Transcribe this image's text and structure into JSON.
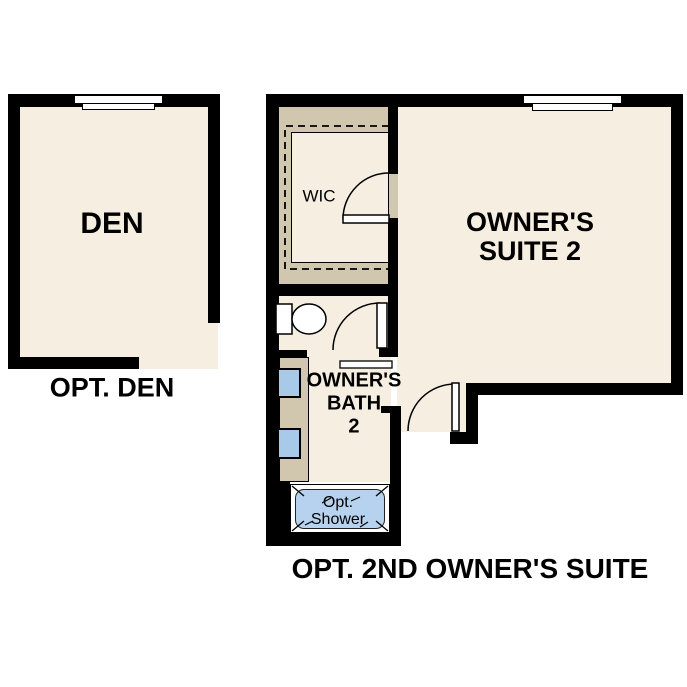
{
  "den_plan": {
    "room_label": "DEN",
    "caption": "OPT. DEN"
  },
  "suite_plan": {
    "wic_label": "WIC",
    "suite_label_line1": "OWNER'S",
    "suite_label_line2": "SUITE 2",
    "bath_label_line1": "OWNER'S",
    "bath_label_line2": "BATH",
    "bath_label_line3": "2",
    "shower_label_line1": "Opt.",
    "shower_label_line2": "Shower",
    "caption": "OPT. 2ND OWNER'S SUITE"
  },
  "colors": {
    "wall": "#000000",
    "floor": "#f5eee1",
    "casework": "#d1c6ae",
    "sink_fill": "#a9c9e8",
    "shower_fill": "#b7d2ee",
    "background": "#ffffff"
  }
}
